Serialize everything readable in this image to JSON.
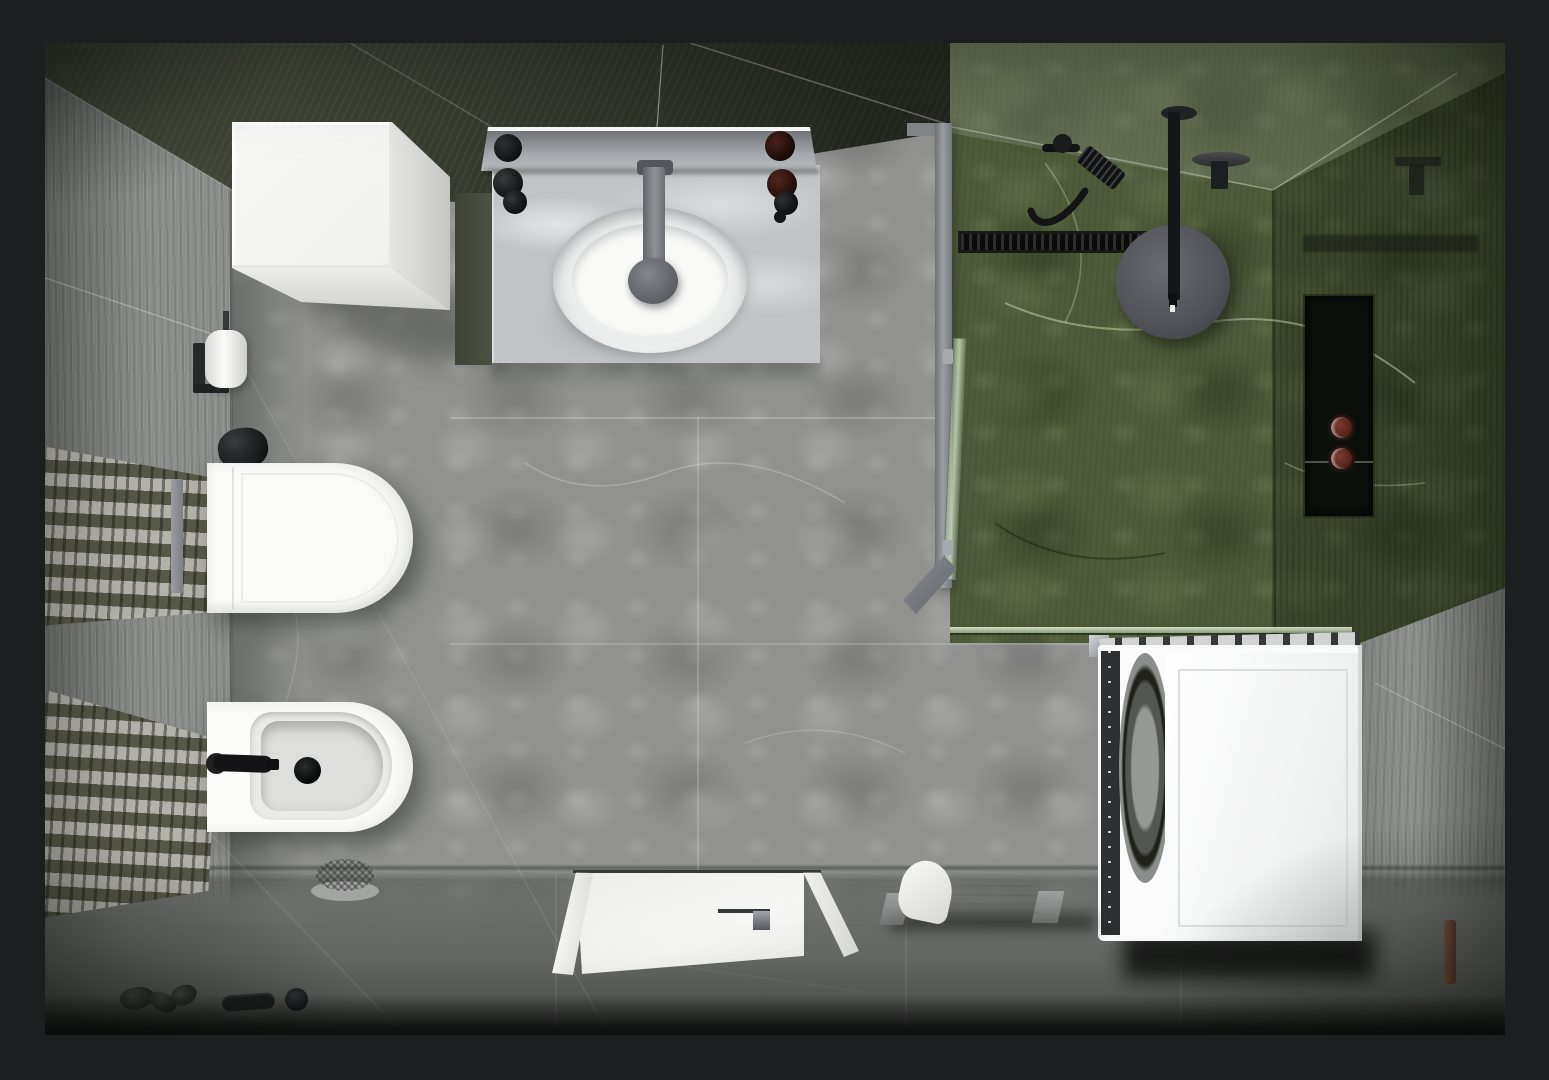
{
  "image": {
    "kind": "photorealistic 3D architectural render",
    "view": "top-down bird's-eye view",
    "subject": "modern bathroom interior floor plan",
    "border": "dark matte frame around the render"
  },
  "palette": {
    "frame": "#1d1e20",
    "floor_marble": "#919290",
    "floor_south": "#656865",
    "wall_west_gray": "#8a8d8a",
    "wall_north_dark_green": "#363b2f",
    "shower_green_marble": "#4e5b3a",
    "shower_green_dark": "#3a452e",
    "east_wall_gray": "#8d908d",
    "porcelain_white": "#fbfbfa",
    "counter_marble": "#c2c5c8",
    "fixture_black": "#141517",
    "chrome_gray": "#9ba0a3",
    "towel_white": "#f6f6f4",
    "jar_brown": "#4c2119",
    "wood_peg": "#6b4a33"
  },
  "surfaces": [
    {
      "id": "floor",
      "label": "light gray marble floor tiles"
    },
    {
      "id": "south-floor",
      "label": "darker gray stone floor band along bottom wall"
    },
    {
      "id": "west-wall",
      "label": "gray striated stone wall with two mosaic tile bands"
    },
    {
      "id": "north-wall",
      "label": "dark olive-green marble wall behind vanity"
    },
    {
      "id": "shower-walls",
      "label": "green marble walk-in shower walls and floor"
    },
    {
      "id": "east-wall",
      "label": "gray stone wall on right side"
    }
  ],
  "objects": [
    {
      "id": 0,
      "label": "white storage cube cabinet"
    },
    {
      "id": 1,
      "label": "white marble vanity counter"
    },
    {
      "id": 2,
      "label": "wall mirror with white frame"
    },
    {
      "id": 3,
      "label": "oval vessel wash basin"
    },
    {
      "id": 4,
      "label": "gray single-lever basin faucet"
    },
    {
      "id": 5,
      "label": "wall-hung toilet with closed lid"
    },
    {
      "id": 6,
      "label": "wall-hung bidet with black faucet"
    },
    {
      "id": 7,
      "label": "toilet paper roll on black holder"
    },
    {
      "id": 8,
      "label": "black flush actuator object"
    },
    {
      "id": 9,
      "label": "upper mosaic tile band on west wall"
    },
    {
      "id": 10,
      "label": "lower mosaic tile band on west wall"
    },
    {
      "id": 11,
      "label": "walk-in shower with green marble"
    },
    {
      "id": 12,
      "label": "glass shower screen with gray frame"
    },
    {
      "id": 13,
      "label": "hinged glass shower door ajar"
    },
    {
      "id": 14,
      "label": "black linear shower drain"
    },
    {
      "id": 15,
      "label": "ceiling rain shower head on black arm"
    },
    {
      "id": 16,
      "label": "black hand shower with hose and mixer"
    },
    {
      "id": 17,
      "label": "recessed shower niche"
    },
    {
      "id": 18,
      "label": "two brown jars inside niche"
    },
    {
      "id": 19,
      "label": "white front-loading washing machine"
    },
    {
      "id": 20,
      "label": "white towel folded on stand"
    },
    {
      "id": 21,
      "label": "white shower tray"
    },
    {
      "id": 22,
      "label": "chrome tray drain fitting"
    },
    {
      "id": 23,
      "label": "wire soap dish on floor"
    },
    {
      "id": 24,
      "label": "decorative dark pebbles"
    },
    {
      "id": 25,
      "label": "black door handle on floor"
    },
    {
      "id": 26,
      "label": "round black floor cap"
    },
    {
      "id": 27,
      "label": "small wooden peg by east wall"
    }
  ]
}
